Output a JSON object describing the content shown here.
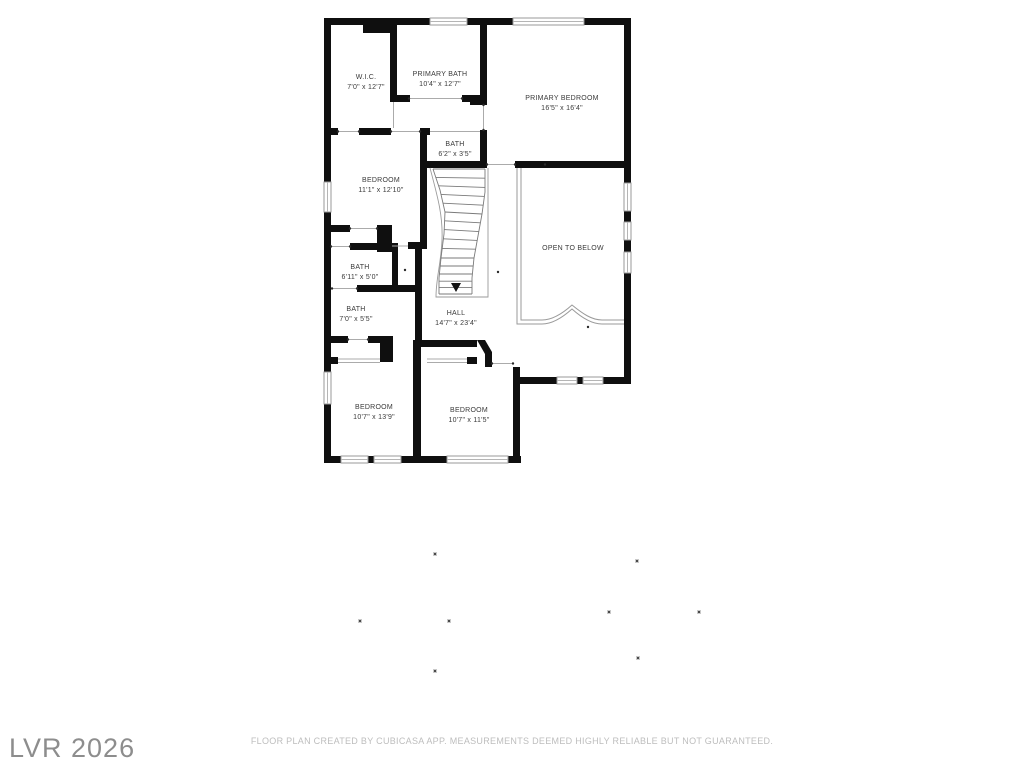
{
  "watermark": {
    "text": "LVR 2026"
  },
  "footer": {
    "disclaimer": "FLOOR PLAN CREATED BY CUBICASA APP. MEASUREMENTS DEEMED HIGHLY RELIABLE BUT NOT GUARANTEED."
  },
  "floor_plan": {
    "floor_label": "",
    "rooms": [
      {
        "name": "W.I.C.",
        "dimensions": "7'0\" x 12'7\"",
        "x": 366,
        "y": 73
      },
      {
        "name": "PRIMARY BATH",
        "dimensions": "10'4\" x 12'7\"",
        "x": 440,
        "y": 70
      },
      {
        "name": "PRIMARY BEDROOM",
        "dimensions": "16'5\" x 16'4\"",
        "x": 562,
        "y": 94
      },
      {
        "name": "BATH",
        "dimensions": "6'2\" x 3'5\"",
        "x": 455,
        "y": 140
      },
      {
        "name": "BEDROOM",
        "dimensions": "11'1\" x 12'10\"",
        "x": 381,
        "y": 176
      },
      {
        "name": "OPEN TO BELOW",
        "dimensions": "",
        "x": 573,
        "y": 244
      },
      {
        "name": "BATH",
        "dimensions": "6'11\" x 5'0\"",
        "x": 360,
        "y": 263
      },
      {
        "name": "BATH",
        "dimensions": "7'0\" x 5'5\"",
        "x": 356,
        "y": 305
      },
      {
        "name": "HALL",
        "dimensions": "14'7\" x 23'4\"",
        "x": 456,
        "y": 309
      },
      {
        "name": "BEDROOM",
        "dimensions": "10'7\" x 13'9\"",
        "x": 374,
        "y": 403
      },
      {
        "name": "BEDROOM",
        "dimensions": "10'7\" x 11'5\"",
        "x": 469,
        "y": 406
      }
    ],
    "scatter_dots": [
      [
        434,
        553
      ],
      [
        636,
        560
      ],
      [
        608,
        611
      ],
      [
        698,
        611
      ],
      [
        359,
        620
      ],
      [
        448,
        620
      ],
      [
        637,
        657
      ],
      [
        434,
        670
      ]
    ]
  },
  "colors": {
    "wall": "#0f0f0f",
    "room_label": "#3a3a3a",
    "thin_line": "#9a9a9a",
    "watermark": "#8d8d8d",
    "disclaimer": "#bdbdbd",
    "background": "#ffffff"
  }
}
